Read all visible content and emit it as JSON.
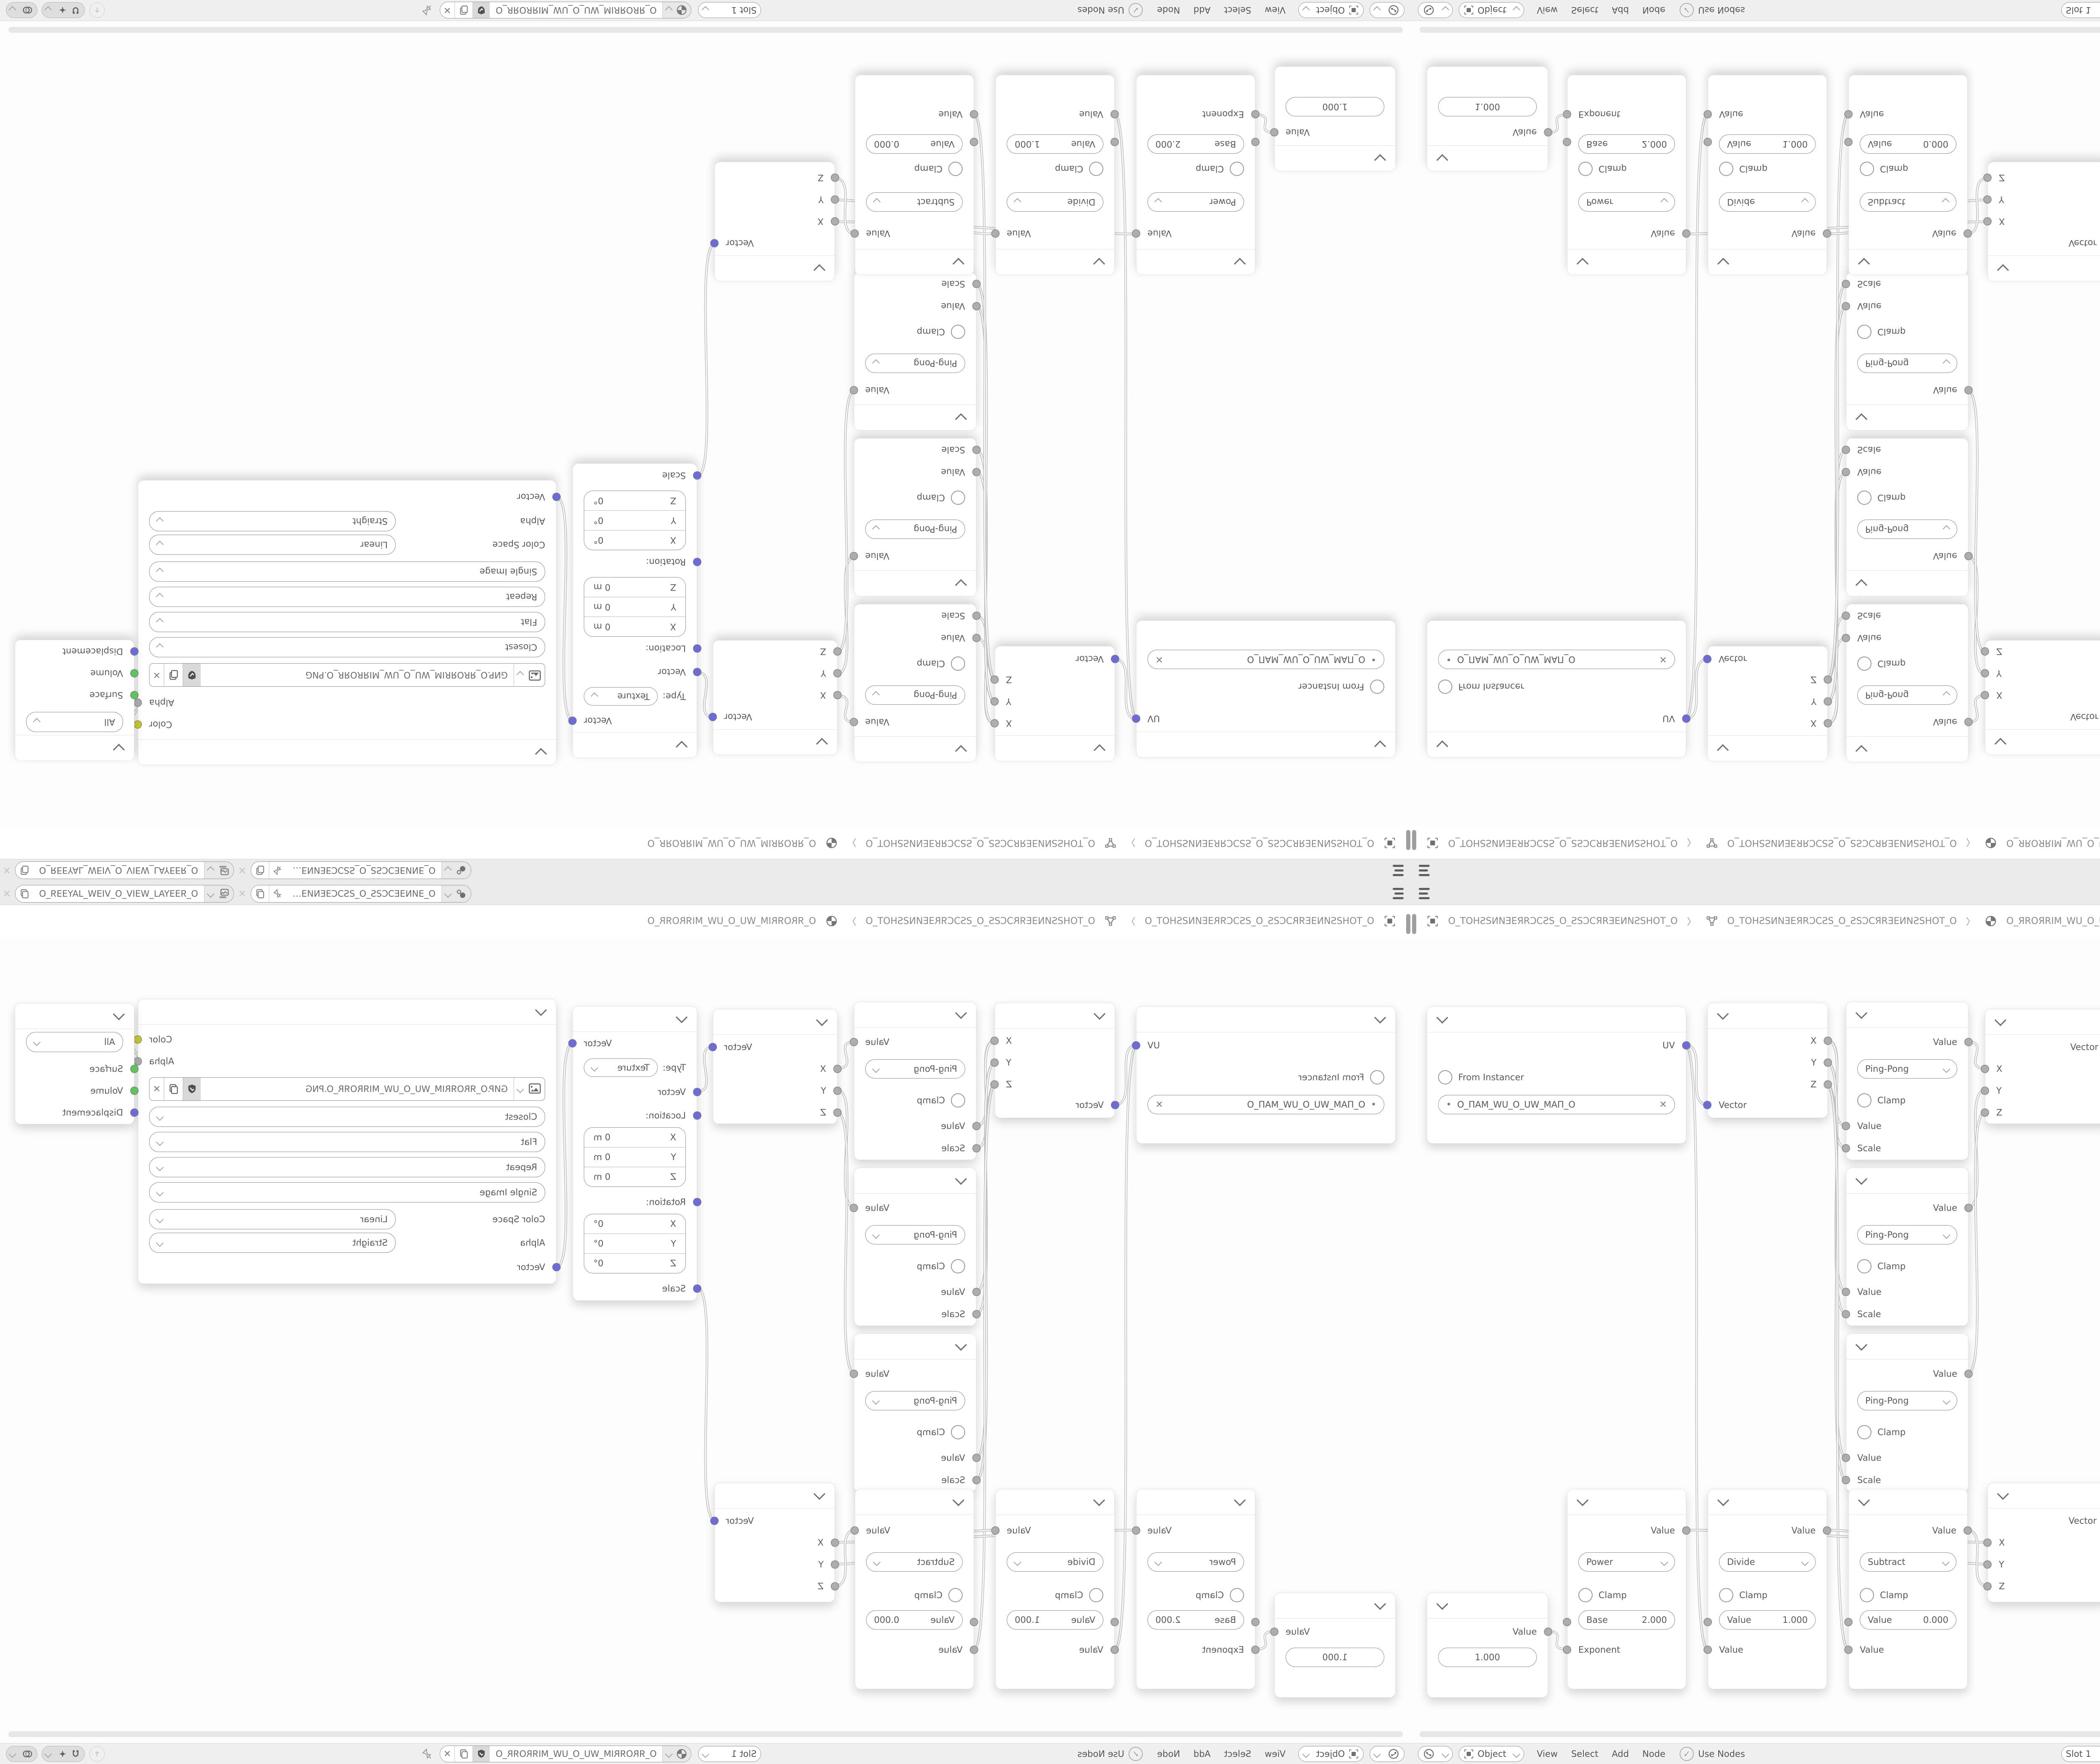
{
  "meta": {
    "app": "blender-shader-editor",
    "layout_note": "2x2 grid of one source screenshot: bottom-right normal, bottom-left mirrored horizontally, top-right mirrored vertically, top-left rotated 180"
  },
  "icons": {
    "close": "✕",
    "bullet": "•",
    "check": "✓",
    "separator": "〉"
  },
  "colors": {
    "socket_vector": "#6e6ad8",
    "socket_value": "#aeaeae",
    "socket_color": "#c6c832",
    "socket_shader": "#62c162",
    "wire": "#c2c2c2",
    "bar_bg": "#ebebeb",
    "header_bg": "#f0f0f0",
    "node_bg": "#ffffff",
    "canvas_bg": "#fdfdfd",
    "text": "#5a5a5a"
  },
  "window": {
    "topbar": {
      "scene_name": "O_ƎИNƎEƆCƧS_O_ƧSƆCƎENИƎ…",
      "view_layer_name": "O_ЯƎƎYA⅃_WƎIV_O_VIƎW_⅃AYƎƎЯ_O"
    },
    "path_bar": {
      "separator": "〉",
      "items": [
        {
          "icon": "object-icon",
          "label": "O_TOHƧSИNƎEЯRƆCƧS_O_ƧSƆCЯRƎEИNƧSHOT_O"
        },
        {
          "icon": "mesh-data-icon",
          "label": "O_TOHƧSИNƎEЯRƆCƧS_O_ƧSƆCЯRƎEИNƧSHOT_O"
        },
        {
          "icon": "material-icon",
          "label": "O_ЯROЯRIM_WU_O_UW_MIЯROЯR_O"
        }
      ]
    },
    "header": {
      "mode": "Object",
      "menus": [
        "View",
        "Select",
        "Add",
        "Node"
      ],
      "use_nodes_label": "Use Nodes",
      "slot": "Slot 1",
      "material_name": "O_ЯROЯRIM_WU_O_UW_MIЯROЯR_O"
    }
  },
  "nodes": {
    "uv_map": {
      "output": "UV",
      "from_instancer": "From Instancer",
      "uv_name": "O_ПAM_WU_O_UW_MAП_O"
    },
    "separate_xyz": {
      "out_x": "X",
      "out_y": "Y",
      "out_z": "Z",
      "input": "Vector"
    },
    "math_pingpong": {
      "output": "Value",
      "operation": "Ping-Pong",
      "clamp": "Clamp",
      "in_value": "Value",
      "in_scale": "Scale"
    },
    "combine_xyz": {
      "output": "Vector",
      "in_x": "X",
      "in_y": "Y",
      "in_z": "Z"
    },
    "mapping": {
      "output": "Vector",
      "type_label": "Type:",
      "type_value": "Texture",
      "in_vector": "Vector",
      "location_label": "Location:",
      "rotation_label": "Rotation:",
      "scale_label": "Scale",
      "axis_x": "X",
      "axis_y": "Y",
      "axis_z": "Z",
      "location_value": "0 m",
      "rotation_value": "0°"
    },
    "image_texture": {
      "out_color": "Color",
      "out_alpha": "Alpha",
      "filename": "GИP.O_ЯROЯRIM_WU_O_UW_MIЯROЯR_O.PNG",
      "interpolation": "Closest",
      "projection": "Flat",
      "extension": "Repeat",
      "source": "Single Image",
      "color_space_label": "Color Space",
      "color_space_value": "Linear",
      "alpha_label": "Alpha",
      "alpha_value": "Straight",
      "in_vector": "Vector"
    },
    "material_output": {
      "target": "All",
      "in_surface": "Surface",
      "in_volume": "Volume",
      "in_displacement": "Displacement"
    },
    "value_node": {
      "output": "Value",
      "value": "1.000"
    },
    "math_power": {
      "output": "Value",
      "operation": "Power",
      "clamp": "Clamp",
      "field_label": "Base",
      "field_value": "2.000",
      "in_label": "Exponent"
    },
    "math_divide": {
      "output": "Value",
      "operation": "Divide",
      "clamp": "Clamp",
      "field_label": "Value",
      "field_value": "1.000",
      "in_label": "Value"
    },
    "math_subtract": {
      "output": "Value",
      "operation": "Subtract",
      "clamp": "Clamp",
      "field_label": "Value",
      "field_value": "0.000",
      "in_label": "Value"
    }
  }
}
